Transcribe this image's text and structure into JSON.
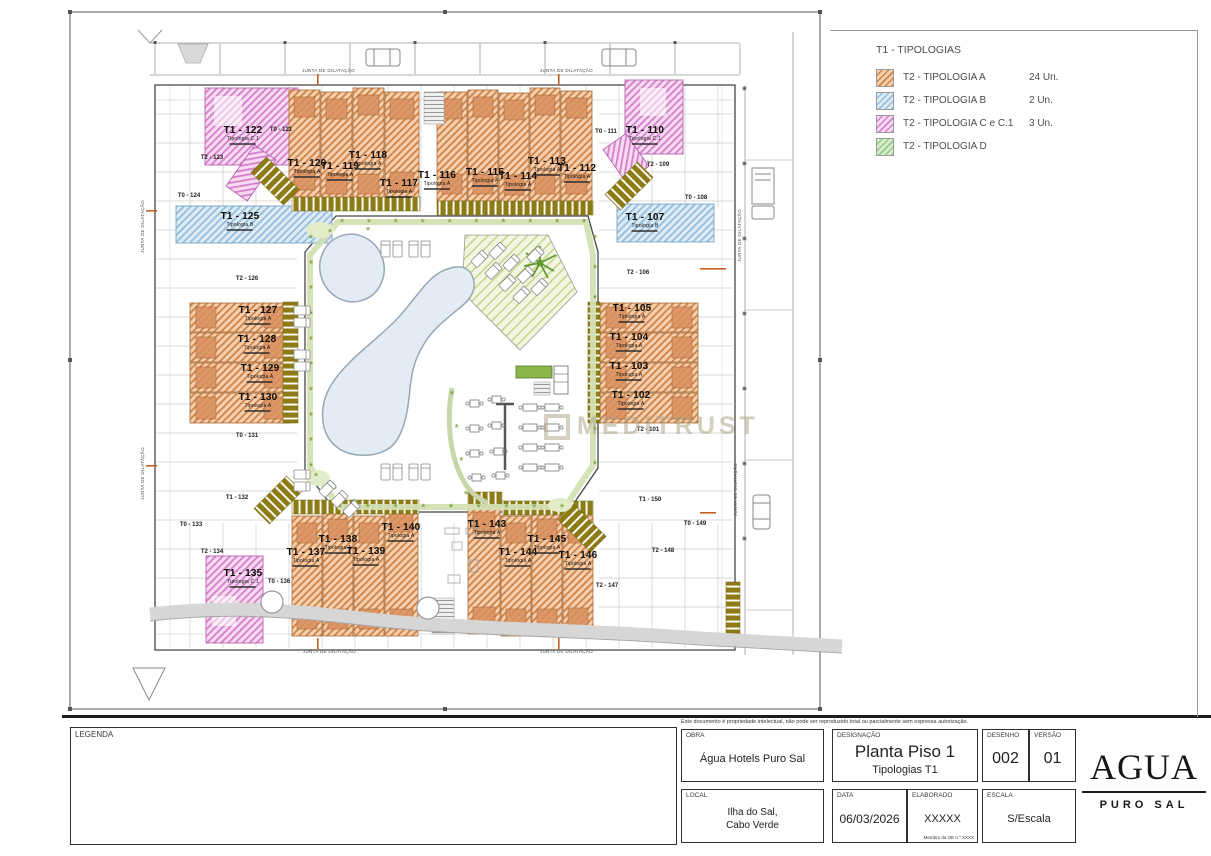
{
  "watermark": {
    "text": "MEDITRUST"
  },
  "legend_panel": {
    "title": "T1 - TIPOLOGIAS",
    "items": [
      {
        "label": "T2 - TIPOLOGIA A",
        "count": "24 Un.",
        "base": "#f5cfae",
        "line": "#cc8348"
      },
      {
        "label": "T2 - TIPOLOGIA B",
        "count": "2 Un.",
        "base": "#ddebf5",
        "line": "#95bddb"
      },
      {
        "label": "T2 - TIPOLOGIA C e C.1",
        "count": "3 Un.",
        "base": "#f6dbf2",
        "line": "#d57fc9"
      },
      {
        "label": "T2 - TIPOLOGIA D",
        "count": "",
        "base": "#d9eccf",
        "line": "#8fcb84"
      }
    ]
  },
  "plan": {
    "junta_label": "JUNTA DE DILATAÇÃO",
    "units": [
      {
        "label": "T1 - 122",
        "sub": "Tipologia C.1"
      },
      {
        "label": "T0 - 121",
        "sub": ""
      },
      {
        "label": "T2 - 123",
        "sub": ""
      },
      {
        "label": "T0 - 124",
        "sub": ""
      },
      {
        "label": "T1 - 125",
        "sub": "Tipologia B"
      },
      {
        "label": "T1 - 120",
        "sub": "Tipologia A"
      },
      {
        "label": "T1 - 119",
        "sub": "Tipologia A"
      },
      {
        "label": "T1 - 118",
        "sub": "Tipologia A"
      },
      {
        "label": "T1 - 117",
        "sub": "Tipologia A"
      },
      {
        "label": "T1 - 116",
        "sub": "Tipologia A"
      },
      {
        "label": "T1 - 115",
        "sub": "Tipologia A"
      },
      {
        "label": "T1 - 114",
        "sub": "Tipologia A"
      },
      {
        "label": "T1 - 113",
        "sub": "Tipologia A"
      },
      {
        "label": "T1 - 112",
        "sub": "Tipologia A"
      },
      {
        "label": "T0 - 111",
        "sub": ""
      },
      {
        "label": "T1 - 110",
        "sub": "Tipologia C.1"
      },
      {
        "label": "T2 - 109",
        "sub": ""
      },
      {
        "label": "T0 - 108",
        "sub": ""
      },
      {
        "label": "T1 - 107",
        "sub": "Tipologia B"
      },
      {
        "label": "T2 - 126",
        "sub": ""
      },
      {
        "label": "T1 - 127",
        "sub": "Tipologia A"
      },
      {
        "label": "T1 - 128",
        "sub": "Tipologia A"
      },
      {
        "label": "T1 - 129",
        "sub": "Tipologia A"
      },
      {
        "label": "T1 - 130",
        "sub": "Tipologia A"
      },
      {
        "label": "T0 - 131",
        "sub": ""
      },
      {
        "label": "T2 - 106",
        "sub": ""
      },
      {
        "label": "T1 - 105",
        "sub": "Tipologia A"
      },
      {
        "label": "T1 - 104",
        "sub": "Tipologia A"
      },
      {
        "label": "T1 - 103",
        "sub": "Tipologia A"
      },
      {
        "label": "T1 - 102",
        "sub": "Tipologia A"
      },
      {
        "label": "T2 - 101",
        "sub": ""
      },
      {
        "label": "T1 - 132",
        "sub": ""
      },
      {
        "label": "T0 - 133",
        "sub": ""
      },
      {
        "label": "T2 - 134",
        "sub": ""
      },
      {
        "label": "T1 - 135",
        "sub": "Tipologia C.1"
      },
      {
        "label": "T0 - 136",
        "sub": ""
      },
      {
        "label": "T1 - 137",
        "sub": "Tipologia A"
      },
      {
        "label": "T1 - 138",
        "sub": "Tipologia A"
      },
      {
        "label": "T1 - 139",
        "sub": "Tipologia A"
      },
      {
        "label": "T1 - 140",
        "sub": "Tipologia A"
      },
      {
        "label": "T1 - 143",
        "sub": "Tipologia A"
      },
      {
        "label": "T1 - 144",
        "sub": "Tipologia A"
      },
      {
        "label": "T1 - 145",
        "sub": "Tipologia A"
      },
      {
        "label": "T1 - 146",
        "sub": "Tipologia A"
      },
      {
        "label": "T2 - 147",
        "sub": ""
      },
      {
        "label": "T2 - 148",
        "sub": ""
      },
      {
        "label": "T0 - 149",
        "sub": ""
      },
      {
        "label": "T1 - 150",
        "sub": ""
      }
    ]
  },
  "title_block": {
    "disclaimer": "Este documento é propriedade intelectual, não pode ser reproduzido total ou parcialmente sem expressa autorização.",
    "legenda_label": "LEGENDA",
    "obra": {
      "label": "OBRA",
      "value": "Água Hotels Puro Sal"
    },
    "designacao": {
      "label": "DESIGNAÇÃO",
      "value": "Planta Piso 1",
      "value2": "Tipologias T1"
    },
    "desenho": {
      "label": "DESENHO",
      "value": "002"
    },
    "versao": {
      "label": "VERSÃO",
      "value": "01"
    },
    "local": {
      "label": "LOCAL",
      "value": "Ilha do Sal,",
      "value2": "Cabo Verde"
    },
    "data": {
      "label": "DATA",
      "value": "06/03/2026"
    },
    "elaborado": {
      "label": "ELABORADO",
      "value": "XXXXX",
      "mini": "Membro da OE n.º XXXX"
    },
    "escala": {
      "label": "ESCALA",
      "value": "S/Escala"
    },
    "logo": {
      "name": "AGUA",
      "sub": "PURO SAL"
    }
  }
}
